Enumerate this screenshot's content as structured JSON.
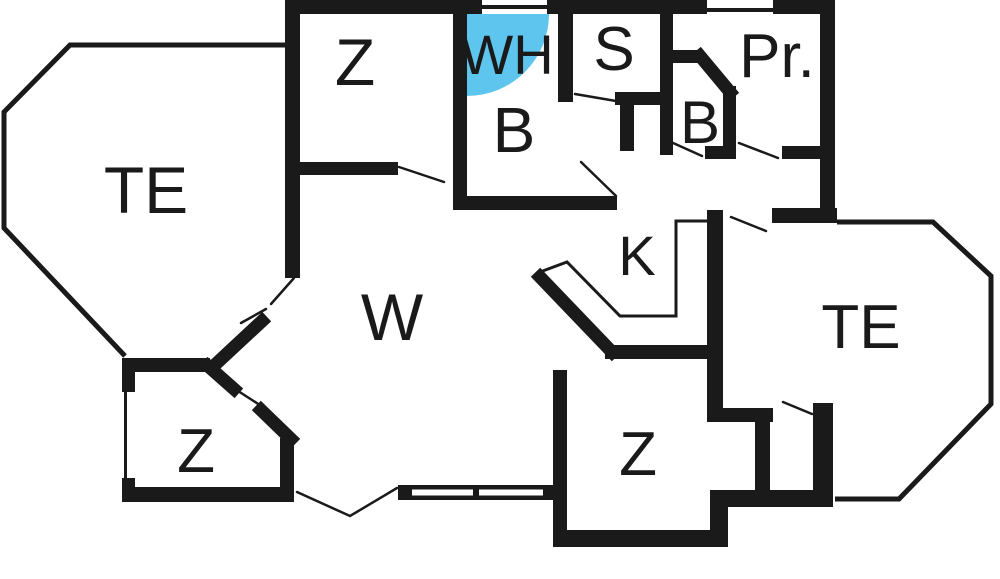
{
  "title": "Apartment floor plan",
  "colors": {
    "wall": "#1a1a1a",
    "background": "#ffffff",
    "highlight": "#5ec5ee",
    "text": "#1a1a1a"
  },
  "rooms": [
    {
      "id": "te-left",
      "label": "TE"
    },
    {
      "id": "z-top",
      "label": "Z"
    },
    {
      "id": "wh",
      "label": "WH"
    },
    {
      "id": "s",
      "label": "S"
    },
    {
      "id": "pr",
      "label": "Pr."
    },
    {
      "id": "b-main",
      "label": "B"
    },
    {
      "id": "b-small",
      "label": "B"
    },
    {
      "id": "k",
      "label": "K"
    },
    {
      "id": "w",
      "label": "W"
    },
    {
      "id": "te-right",
      "label": "TE"
    },
    {
      "id": "z-bottom-left",
      "label": "Z"
    },
    {
      "id": "z-bottom-mid",
      "label": "Z"
    }
  ],
  "highlight_marker": {
    "room": "WH",
    "shape": "quarter-circle"
  }
}
